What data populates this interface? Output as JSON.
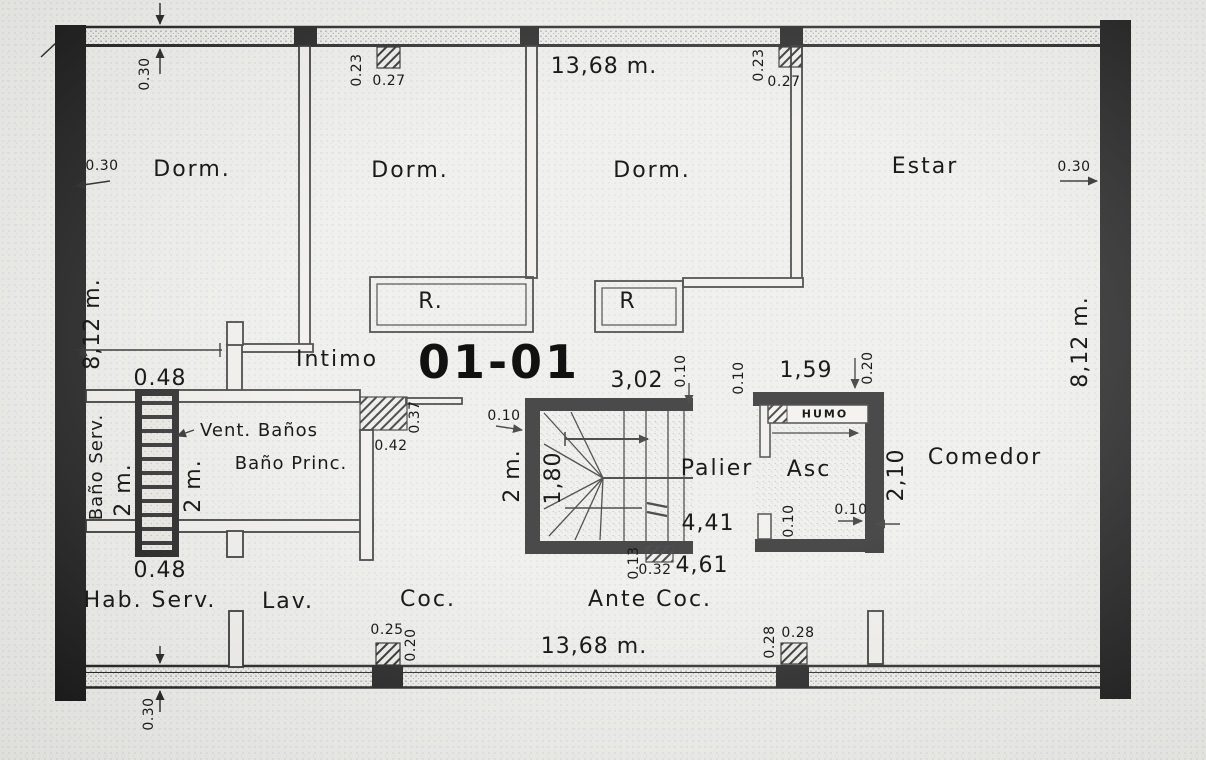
{
  "title": "01-01",
  "rooms": {
    "dorm1": "Dorm.",
    "dorm2": "Dorm.",
    "dorm3": "Dorm.",
    "estar": "Estar",
    "intimo": "Intimo",
    "vent_banos": "Vent. Baños",
    "bano_princ": "Baño Princ.",
    "bano_serv": "Baño Serv.",
    "hab_serv": "Hab. Serv.",
    "lav": "Lav.",
    "coc": "Coc.",
    "ante_coc": "Ante Coc.",
    "palier": "Palier",
    "asc": "Asc",
    "comedor": "Comedor",
    "humo": "HUMO",
    "closet1": "R.",
    "closet2": "R"
  },
  "dims": {
    "top_total": "13,68 m.",
    "bottom_total": "13,68 m.",
    "left_height": "8,12 m.",
    "right_height": "8,12 m.",
    "wall_top": "0.30",
    "wall_left": "0.30",
    "wall_right": "0.30",
    "wall_bottom": "0.30",
    "shaft_top": "0.48",
    "shaft_bottom": "0.48",
    "col_top1_a": "0.23",
    "col_top1_b": "0.27",
    "col_top2_a": "0.23",
    "col_top2_b": "0.27",
    "col_mid_a": "0.42",
    "col_mid_b": "0.37",
    "col_bot1_a": "0.25",
    "col_bot1_b": "0.20",
    "col_bot2_a": "0.28",
    "col_bot2_b": "0.28",
    "col_stair_a": "0.32",
    "col_stair_b": "0.13",
    "stair_width": "3,02",
    "stair_depth": "2 m.",
    "stair_run": "1,80",
    "bath_serv_depth": "2 m.",
    "bath_princ_depth": "2 m.",
    "palier_len": "4,41",
    "antecoc_len": "4,61",
    "lift_width": "1,59",
    "lift_wall": "0.20",
    "lift_depth": "2,10",
    "off_stair_left": "0.10",
    "off_stair_end": "0.10",
    "off_palier": "0.10",
    "off_lift_v": "0.10",
    "off_lift_h": "0.10"
  }
}
